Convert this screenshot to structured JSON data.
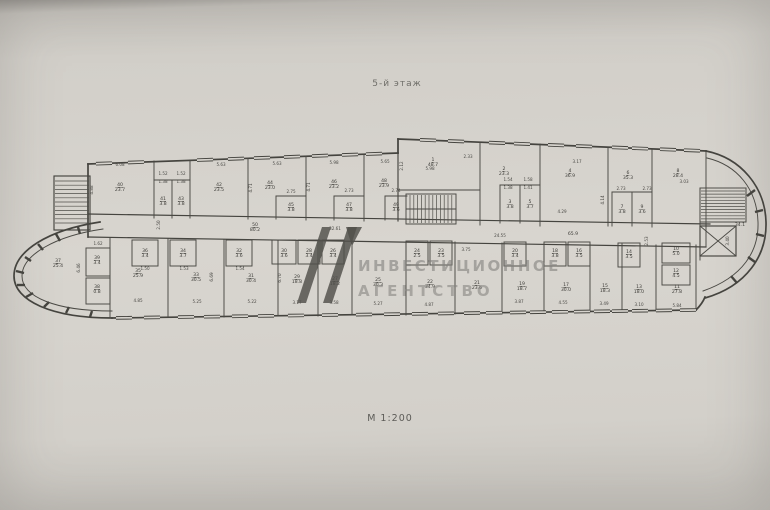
{
  "page": {
    "title": "5-й этаж",
    "scale": "М 1:200"
  },
  "watermark": {
    "line1": "ИНВЕСТИЦИОННОЕ",
    "line2": "АГЕНТСТВО",
    "logo_color": "#514f4b",
    "text_color": "#85837f"
  },
  "colors": {
    "ink": "#45443f",
    "paper": "#d6d3cd"
  },
  "plan": {
    "rooms": [
      {
        "n": "40",
        "a": "23.7",
        "x": 120,
        "y": 186
      },
      {
        "n": "41",
        "a": "3.8",
        "x": 163,
        "y": 200
      },
      {
        "n": "43",
        "a": "3.8",
        "x": 181,
        "y": 200
      },
      {
        "n": "42",
        "a": "23.5",
        "x": 219,
        "y": 186
      },
      {
        "n": "44",
        "a": "23.0",
        "x": 270,
        "y": 184
      },
      {
        "n": "45",
        "a": "3.8",
        "x": 291,
        "y": 206
      },
      {
        "n": "46",
        "a": "23.2",
        "x": 334,
        "y": 183
      },
      {
        "n": "47",
        "a": "3.8",
        "x": 349,
        "y": 206
      },
      {
        "n": "48",
        "a": "23.9",
        "x": 384,
        "y": 182
      },
      {
        "n": "49",
        "a": "3.6",
        "x": 396,
        "y": 206
      },
      {
        "n": "50",
        "a": "80.2",
        "x": 255,
        "y": 226
      },
      {
        "n": "1",
        "a": "48.7",
        "x": 433,
        "y": 161
      },
      {
        "n": "2",
        "a": "23.3",
        "x": 504,
        "y": 170
      },
      {
        "n": "3",
        "a": "3.8",
        "x": 510,
        "y": 203
      },
      {
        "n": "5",
        "a": "3.7",
        "x": 530,
        "y": 203
      },
      {
        "n": "4",
        "a": "36.9",
        "x": 570,
        "y": 172
      },
      {
        "n": "6",
        "a": "35.3",
        "x": 628,
        "y": 174
      },
      {
        "n": "7",
        "a": "3.8",
        "x": 622,
        "y": 208
      },
      {
        "n": "9",
        "a": "3.6",
        "x": 642,
        "y": 208
      },
      {
        "n": "8",
        "a": "28.4",
        "x": 678,
        "y": 172
      },
      {
        "n": "",
        "a": "65.9",
        "x": 573,
        "y": 235
      },
      {
        "n": "",
        "a": "34.1",
        "x": 740,
        "y": 226
      },
      {
        "n": "37",
        "a": "25.4",
        "x": 58,
        "y": 262
      },
      {
        "n": "39",
        "a": "3.4",
        "x": 97,
        "y": 259
      },
      {
        "n": "38",
        "a": "0.8",
        "x": 97,
        "y": 288
      },
      {
        "n": "35",
        "a": "25.9",
        "x": 138,
        "y": 272
      },
      {
        "n": "36",
        "a": "3.4",
        "x": 145,
        "y": 252
      },
      {
        "n": "33",
        "a": "30.5",
        "x": 196,
        "y": 276
      },
      {
        "n": "34",
        "a": "3.7",
        "x": 183,
        "y": 252
      },
      {
        "n": "31",
        "a": "30.4",
        "x": 251,
        "y": 277
      },
      {
        "n": "32",
        "a": "3.6",
        "x": 239,
        "y": 252
      },
      {
        "n": "29",
        "a": "18.8",
        "x": 297,
        "y": 278
      },
      {
        "n": "30",
        "a": "3.6",
        "x": 284,
        "y": 252
      },
      {
        "n": "28",
        "a": "3.4",
        "x": 309,
        "y": 252
      },
      {
        "n": "27",
        "a": "18.2",
        "x": 335,
        "y": 280
      },
      {
        "n": "26",
        "a": "3.4",
        "x": 333,
        "y": 252
      },
      {
        "n": "25",
        "a": "30.3",
        "x": 378,
        "y": 281
      },
      {
        "n": "24",
        "a": "2.5",
        "x": 417,
        "y": 252
      },
      {
        "n": "23",
        "a": "3.5",
        "x": 441,
        "y": 252
      },
      {
        "n": "22",
        "a": "34.9",
        "x": 430,
        "y": 283
      },
      {
        "n": "21",
        "a": "23.6",
        "x": 477,
        "y": 284
      },
      {
        "n": "20",
        "a": "3.4",
        "x": 515,
        "y": 252
      },
      {
        "n": "19",
        "a": "18.7",
        "x": 522,
        "y": 285
      },
      {
        "n": "18",
        "a": "3.8",
        "x": 555,
        "y": 252
      },
      {
        "n": "16",
        "a": "3.5",
        "x": 579,
        "y": 252
      },
      {
        "n": "17",
        "a": "30.0",
        "x": 566,
        "y": 286
      },
      {
        "n": "15",
        "a": "18.3",
        "x": 605,
        "y": 287
      },
      {
        "n": "14",
        "a": "3.5",
        "x": 629,
        "y": 253
      },
      {
        "n": "13",
        "a": "18.0",
        "x": 639,
        "y": 288
      },
      {
        "n": "10",
        "a": "5.0",
        "x": 676,
        "y": 250
      },
      {
        "n": "12",
        "a": "4.5",
        "x": 676,
        "y": 272
      },
      {
        "n": "11",
        "a": "27.8",
        "x": 677,
        "y": 288
      }
    ],
    "dims": [
      {
        "t": "6.08",
        "x": 120,
        "y": 166
      },
      {
        "t": "5.63",
        "x": 221,
        "y": 166
      },
      {
        "t": "5.63",
        "x": 277,
        "y": 165
      },
      {
        "t": "5.98",
        "x": 334,
        "y": 164
      },
      {
        "t": "5.65",
        "x": 385,
        "y": 163
      },
      {
        "t": "1.52",
        "x": 163,
        "y": 175
      },
      {
        "t": "1.52",
        "x": 181,
        "y": 175
      },
      {
        "t": "1.38",
        "x": 163,
        "y": 183
      },
      {
        "t": "1.38",
        "x": 181,
        "y": 183
      },
      {
        "t": "2.75",
        "x": 291,
        "y": 193
      },
      {
        "t": "2.73",
        "x": 349,
        "y": 192
      },
      {
        "t": "2.74",
        "x": 396,
        "y": 192
      },
      {
        "t": "4.88",
        "x": 93,
        "y": 190,
        "r": 1
      },
      {
        "t": "4.71",
        "x": 252,
        "y": 188,
        "r": 1
      },
      {
        "t": "4.71",
        "x": 310,
        "y": 187,
        "r": 1
      },
      {
        "t": "5.98",
        "x": 430,
        "y": 170
      },
      {
        "t": "2.33",
        "x": 468,
        "y": 158
      },
      {
        "t": "3.17",
        "x": 577,
        "y": 163
      },
      {
        "t": "2.12",
        "x": 403,
        "y": 166,
        "r": 1
      },
      {
        "t": "1.54",
        "x": 508,
        "y": 181
      },
      {
        "t": "1.58",
        "x": 528,
        "y": 181
      },
      {
        "t": "1.38",
        "x": 508,
        "y": 189
      },
      {
        "t": "1.41",
        "x": 528,
        "y": 189
      },
      {
        "t": "4.29",
        "x": 562,
        "y": 213
      },
      {
        "t": "4.14",
        "x": 604,
        "y": 200,
        "r": 1
      },
      {
        "t": "2.73",
        "x": 621,
        "y": 190
      },
      {
        "t": "2.73",
        "x": 647,
        "y": 190
      },
      {
        "t": "3.03",
        "x": 684,
        "y": 183
      },
      {
        "t": "2.50",
        "x": 160,
        "y": 225,
        "r": 1
      },
      {
        "t": "32.61",
        "x": 335,
        "y": 230
      },
      {
        "t": "24.55",
        "x": 500,
        "y": 237
      },
      {
        "t": "2.53",
        "x": 648,
        "y": 241,
        "r": 1
      },
      {
        "t": "1.62",
        "x": 98,
        "y": 245
      },
      {
        "t": "6.46",
        "x": 80,
        "y": 268,
        "r": 1
      },
      {
        "t": "1.50",
        "x": 145,
        "y": 270
      },
      {
        "t": "1.53",
        "x": 184,
        "y": 270
      },
      {
        "t": "1.54",
        "x": 240,
        "y": 270
      },
      {
        "t": "6.69",
        "x": 213,
        "y": 277,
        "r": 1
      },
      {
        "t": "6.70",
        "x": 281,
        "y": 278,
        "r": 1
      },
      {
        "t": "4.85",
        "x": 138,
        "y": 302
      },
      {
        "t": "5.25",
        "x": 197,
        "y": 303
      },
      {
        "t": "5.22",
        "x": 252,
        "y": 303
      },
      {
        "t": "3.17",
        "x": 297,
        "y": 304
      },
      {
        "t": "3.58",
        "x": 334,
        "y": 304
      },
      {
        "t": "5.27",
        "x": 378,
        "y": 305
      },
      {
        "t": "4.87",
        "x": 429,
        "y": 306
      },
      {
        "t": "3.75",
        "x": 466,
        "y": 251
      },
      {
        "t": "3.87",
        "x": 519,
        "y": 303
      },
      {
        "t": "4.55",
        "x": 563,
        "y": 304
      },
      {
        "t": "3.49",
        "x": 604,
        "y": 305
      },
      {
        "t": "3.10",
        "x": 639,
        "y": 306
      },
      {
        "t": "5.84",
        "x": 677,
        "y": 307
      },
      {
        "t": "3.40",
        "x": 729,
        "y": 241,
        "r": 1
      }
    ]
  }
}
